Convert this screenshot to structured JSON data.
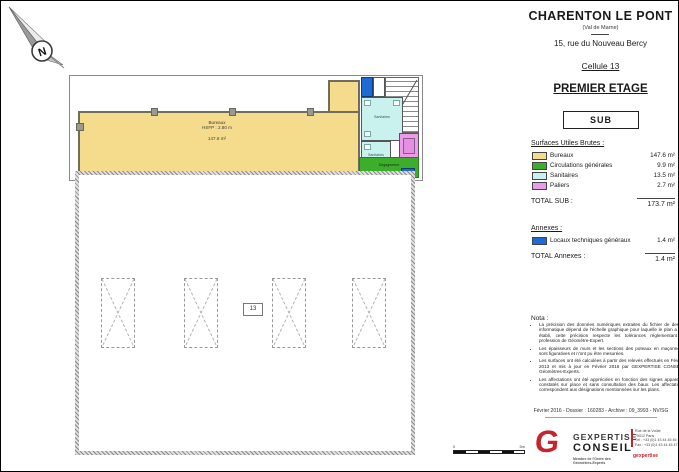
{
  "title_block": {
    "city": "CHARENTON LE PONT",
    "dept": "(Val de Marne)",
    "address": "15, rue du Nouveau Bercy",
    "cell": "Cellule 13",
    "floor": "PREMIER ETAGE",
    "sub": "SUB"
  },
  "surfaces": {
    "heading": "Surfaces Utiles Brutes :",
    "rows": [
      {
        "label": "Bureaux",
        "value": "147.6 m²",
        "color": "#F4DC8C"
      },
      {
        "label": "Circulations générales",
        "value": "9.9 m²",
        "color": "#3CAE2C"
      },
      {
        "label": "Sanitaires",
        "value": "13.5 m²",
        "color": "#C9F2EE"
      },
      {
        "label": "Paliers",
        "value": "2.7 m²",
        "color": "#EC9AEA"
      }
    ],
    "total_label": "TOTAL SUB :",
    "total_value": "173.7 m²"
  },
  "annexes": {
    "heading": "Annexes :",
    "rows": [
      {
        "label": "Locaux techniques généraux",
        "value": "1.4 m²",
        "color": "#1E6BD6"
      }
    ],
    "total_label": "TOTAL Annexes :",
    "total_value": "1.4 m²"
  },
  "nota": {
    "heading": "Nota :",
    "items": [
      "La précision des données numériques extraites du fichier de dessin informatique dépend de l'échelle graphique pour laquelle le plan a été établi, cette précision respecte les tolérances réglementant la profession de Géomètre-Expert.",
      "Les épaisseurs de murs et les sections des poteaux en maçonnerie sont figuratives et n'ont pu être mesurées.",
      "Les surfaces ont été calculées à partir des relevés effectués en Février 2013 et mis à jour en Février 2016 par GEXPERTISE CONSEIL, Géomètres-Experts.",
      "Les affectations ont été appréciées en fonction des signes apparents constatés sur place et sans consultation des baux. Les affectations correspondent aux désignations mentionnées sur les plans."
    ]
  },
  "footer": {
    "date_line": "Février 2016 - Dossier : 160283 - Archive : 09_3993 - NV/SG",
    "logo": {
      "g_letter": "G",
      "name_top": "GEXPERTISE",
      "name_bottom": "CONSEIL",
      "tagline": "Membre de l'Ordre des Géomètres-Experts"
    },
    "contact": {
      "lines": [
        "Rue de la Voûte",
        "75012 Paris",
        "Tél : +33 (0)1 43 44 45 46",
        "Fax : +33 (0)1 43 44 45 47"
      ],
      "brand": "gexpertise"
    }
  },
  "plan": {
    "north_label": "N",
    "bureaux": {
      "lines": [
        "Bureaux",
        "HSFP : 2.80 m",
        "147.6 m²"
      ]
    },
    "rooms": {
      "sanitaires_1": "Sanitaires",
      "sanitaires_2": "Sanitaires",
      "degagement": "Dégagement"
    },
    "cell_tag": "13",
    "scale": {
      "left_label": "0",
      "right_label": "5m"
    }
  }
}
